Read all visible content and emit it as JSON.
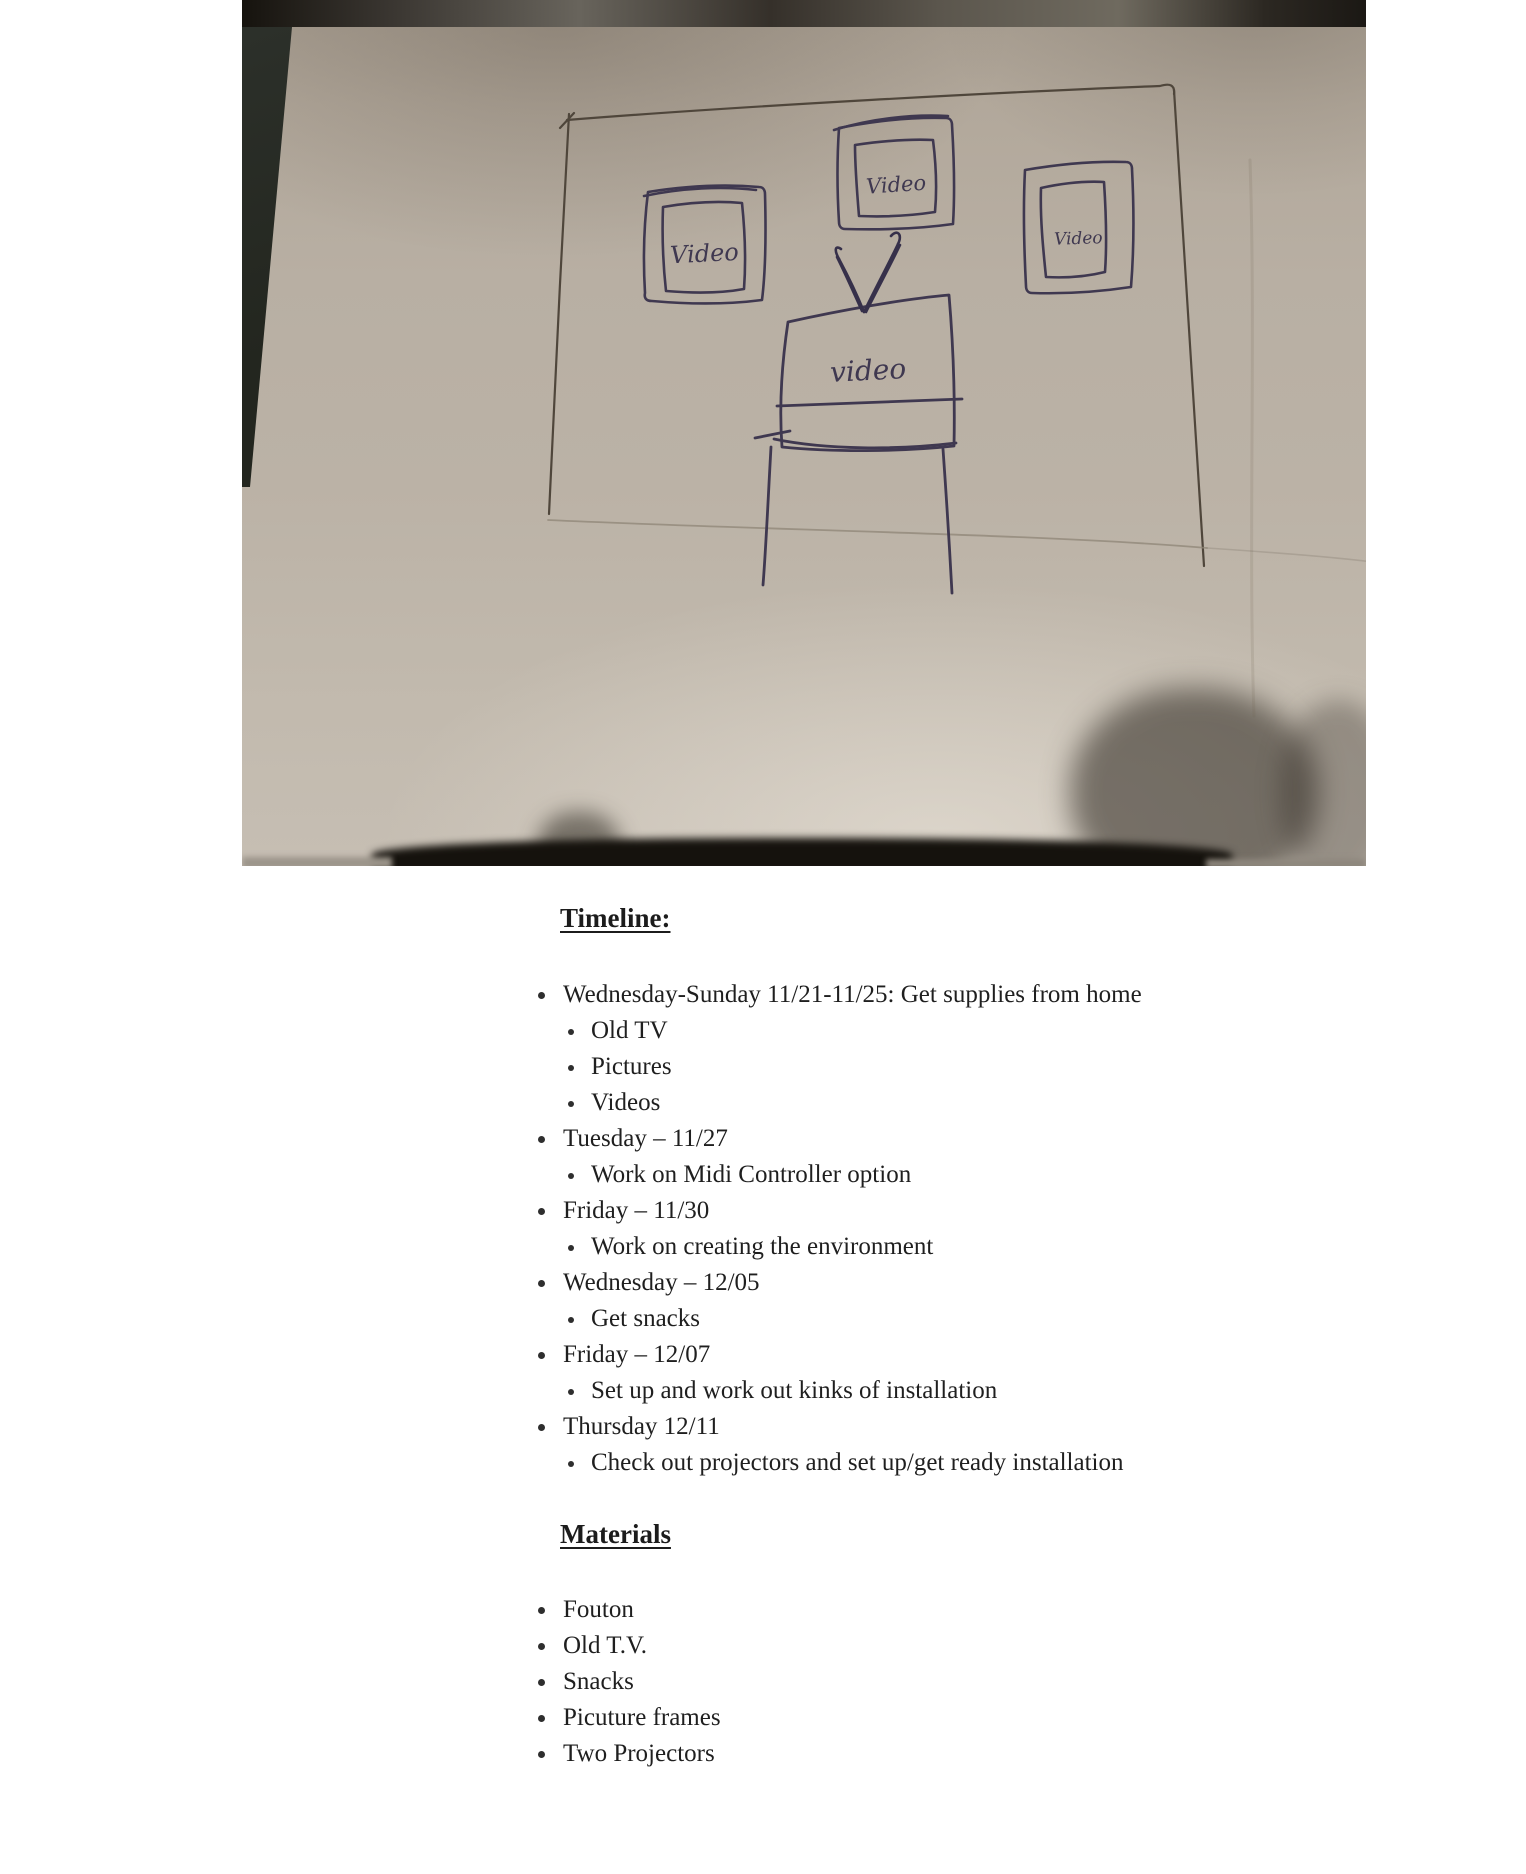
{
  "photo": {
    "sketch": {
      "labels": {
        "frame_left": "Video",
        "frame_top": "Video",
        "frame_right": "Video",
        "tv": "video"
      }
    },
    "colors": {
      "paper": "#b7aea2",
      "ink": "#3f3850",
      "pencil_wall": "#4f463b",
      "fabric": "#23261f"
    }
  },
  "timeline": {
    "heading": "Timeline:",
    "items": [
      {
        "text": "Wednesday-Sunday 11/21-11/25: Get supplies from home",
        "children": [
          "Old TV",
          "Pictures",
          "Videos"
        ]
      },
      {
        "text": "Tuesday – 11/27",
        "children": [
          "Work on Midi Controller option"
        ]
      },
      {
        "text": "Friday – 11/30",
        "children": [
          "Work on creating the environment"
        ]
      },
      {
        "text": "Wednesday – 12/05",
        "children": [
          "Get snacks"
        ]
      },
      {
        "text": "Friday – 12/07",
        "children": [
          "Set up and work out kinks of installation"
        ]
      },
      {
        "text": "Thursday 12/11",
        "children": [
          "Check out projectors and set up/get ready installation"
        ]
      }
    ]
  },
  "materials": {
    "heading": "Materials",
    "items": [
      "Fouton",
      "Old T.V.",
      "Snacks",
      "Picuture frames",
      "Two Projectors"
    ]
  }
}
